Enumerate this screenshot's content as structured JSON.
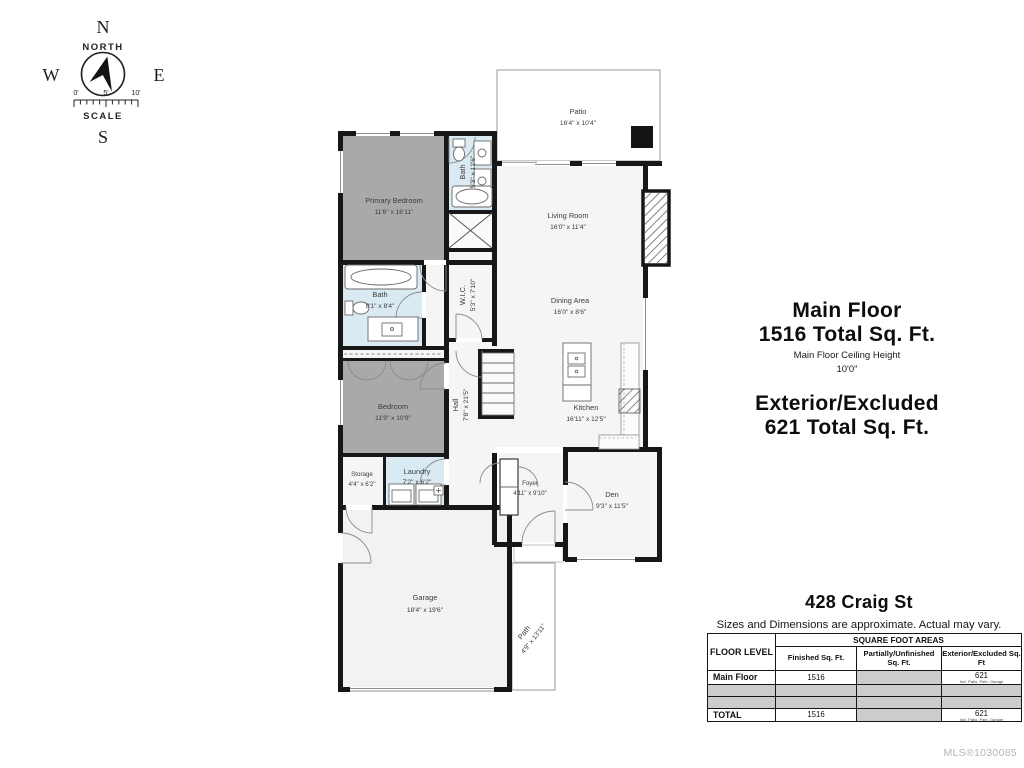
{
  "compass": {
    "n": "N",
    "w": "W",
    "e": "E",
    "s": "S",
    "north_label": "NORTH",
    "scale_label": "SCALE",
    "ticks": [
      "0'",
      "5'",
      "10'"
    ]
  },
  "rooms": {
    "patio": {
      "name": "Patio",
      "dims": "16'4\" x 10'4\""
    },
    "primary_bedroom": {
      "name": "Primary Bedroom",
      "dims": "11'6\" x 16'11\""
    },
    "bath1": {
      "name": "Bath",
      "dims": "5'3\" x 12'6\""
    },
    "living_room": {
      "name": "Living Room",
      "dims": "16'0\" x 11'4\""
    },
    "bath2": {
      "name": "Bath",
      "dims": "8'1\" x 8'4\""
    },
    "wic": {
      "name": "W.I.C.",
      "dims": "5'3\" x 7'10\""
    },
    "dining": {
      "name": "Dining Area",
      "dims": "16'0\" x 8'6\""
    },
    "hall": {
      "name": "Hall",
      "dims": "7'8\" x 21'5\""
    },
    "bedroom": {
      "name": "Bedroom",
      "dims": "11'9\" x 10'9\""
    },
    "kitchen": {
      "name": "Kitchen",
      "dims": "16'11\" x 12'5\""
    },
    "storage": {
      "name": "Storage",
      "dims": "4'4\" x 6'2\""
    },
    "laundry": {
      "name": "Laundry",
      "dims": "7'2\" x 6'2\""
    },
    "foyer": {
      "name": "Foyer",
      "dims": "4'11\" x 9'10\""
    },
    "den": {
      "name": "Den",
      "dims": "9'3\" x 11'5\""
    },
    "garage": {
      "name": "Garage",
      "dims": "18'4\" x 19'6\""
    },
    "path": {
      "name": "Path",
      "dims": "4'9\" x 13'11\""
    }
  },
  "summary": {
    "main_floor_title": "Main Floor",
    "main_floor_total": "1516 Total Sq. Ft.",
    "ceiling_label": "Main Floor Ceiling Height",
    "ceiling_value": "10'0\"",
    "exterior_title": "Exterior/Excluded",
    "exterior_total": "621 Total Sq. Ft."
  },
  "address": {
    "street": "428 Craig St",
    "disclaimer": "Sizes and Dimensions are approximate. Actual may vary."
  },
  "table": {
    "floor_level": "FLOOR LEVEL",
    "group": "SQUARE FOOT AREAS",
    "cols": [
      "Finished Sq. Ft.",
      "Partially/Unfinished Sq. Ft.",
      "Exterior/Excluded Sq. Ft"
    ],
    "rows": [
      {
        "level": "Main Floor",
        "finished": "1516",
        "partial": "",
        "exterior": "621",
        "note": "Incl. Patio, Path, Garage"
      },
      {
        "level": "",
        "finished": "",
        "partial": "",
        "exterior": "",
        "note": ""
      },
      {
        "level": "",
        "finished": "",
        "partial": "",
        "exterior": "",
        "note": ""
      },
      {
        "level": "TOTAL",
        "finished": "1516",
        "partial": "",
        "exterior": "621",
        "note": "Incl. Patio, Path, Garage"
      }
    ]
  },
  "footer": {
    "mls": "MLS®1030085"
  },
  "colors": {
    "wall": "#171717",
    "bedroom_fill": "#a9a9a9",
    "bath_fill": "#d9eaf2",
    "room_fill": "#f5f5f5"
  }
}
